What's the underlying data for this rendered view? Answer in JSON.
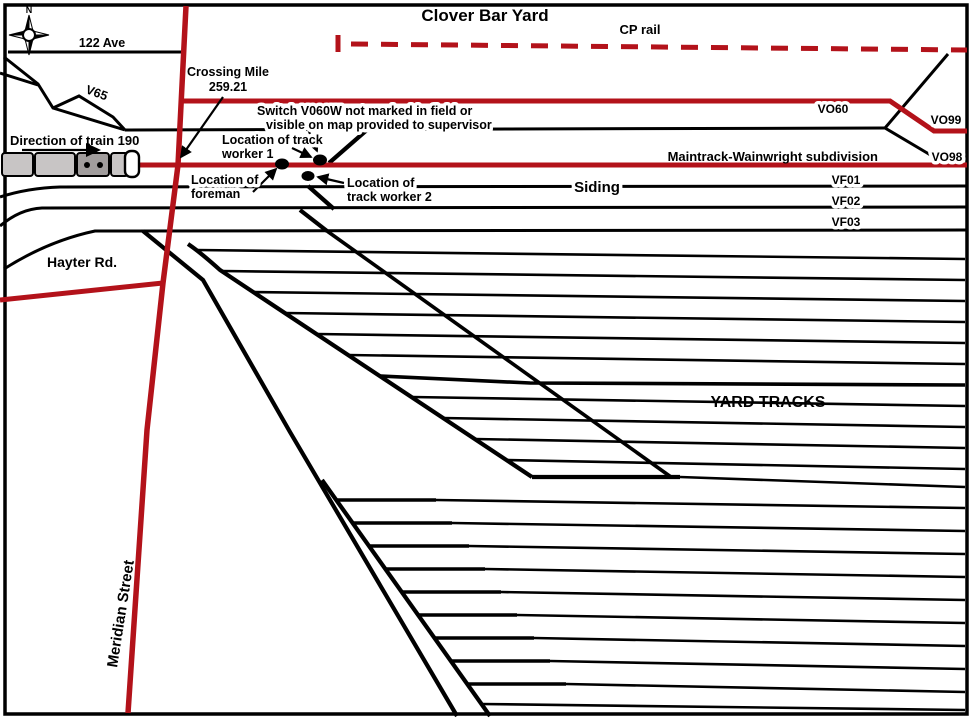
{
  "map_title": "Clover Bar Yard",
  "colors": {
    "track_red": "#b3121a",
    "track_black": "#000000",
    "train_grey": "#c8c5c5",
    "train_dark_grey": "#a19d9d",
    "train_nose_white": "#ffffff"
  },
  "compass": {
    "north_label": "N"
  },
  "roads": {
    "ave_122": "122 Ave",
    "hayter": "Hayter Rd.",
    "meridian": "Meridian Street"
  },
  "rail_labels": {
    "cp": "CP rail",
    "v65": "V65",
    "vo60": "VO60",
    "vo99": "VO99",
    "vo98": "VO98",
    "maintrack": "Maintrack-Wainwright subdivision",
    "siding": "Siding",
    "vf01": "VF01",
    "vf02": "VF02",
    "vf03": "VF03",
    "yard_tracks": "YARD TRACKS"
  },
  "annotations": {
    "direction": "Direction of train 190",
    "crossing": {
      "line1": "Crossing Mile",
      "line2": "259.21"
    },
    "switch_note": {
      "line1": "Switch V060W not marked in field or",
      "line2": "visible on map provided to supervisor"
    },
    "worker1": {
      "line1": "Location of track",
      "line2": "worker 1"
    },
    "foreman": {
      "line1": "Location of",
      "line2": "foreman"
    },
    "worker2": {
      "line1": "Location of",
      "line2": "track worker 2"
    }
  }
}
